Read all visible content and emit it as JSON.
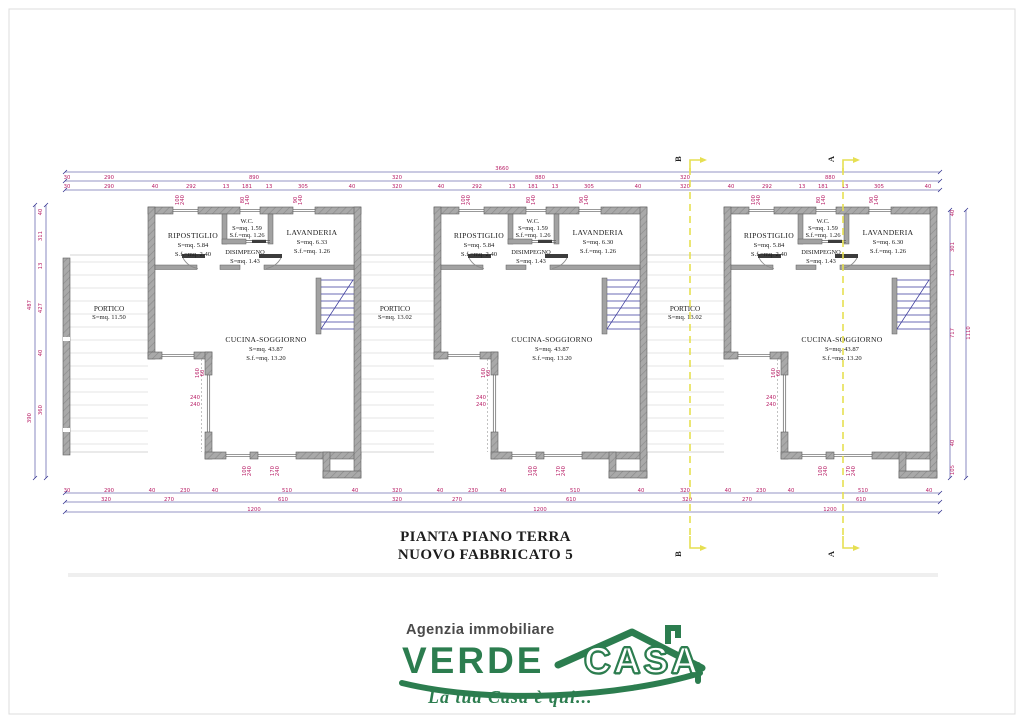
{
  "drawing": {
    "title_line1": "PIANTA PIANO TERRA",
    "title_line2": "NUOVO FABBRICATO 5"
  },
  "logo": {
    "tagline_top": "Agenzia immobiliare",
    "brand_word1": "VERDE",
    "brand_word2": "CASA",
    "tagline_bottom": "La tua Casa è qui...",
    "green": "#2c7d4f",
    "gray": "#4a4a4a"
  },
  "section_markers": {
    "b": "B",
    "a": "A"
  },
  "units": [
    {
      "portico_label": "PORTICO",
      "portico_area": "S=mq. 11.50",
      "ripostiglio_label": "RIPOSTIGLIO",
      "ripostiglio_s": "S=mq. 5.84",
      "ripostiglio_sf": "S.f.=mq. 2.40",
      "wc_label": "W.C.",
      "wc_s": "S=mq. 1.59",
      "wc_sf": "S.f.=mq. 1.26",
      "lavanderia_label": "LAVANDERIA",
      "lavanderia_s": "S=mq. 6.33",
      "lavanderia_sf": "S.f.=mq. 1.26",
      "disimpegno_label": "DISIMPEGNO",
      "disimpegno_s": "S=mq. 1.43",
      "cucina_label": "CUCINA-SOGGIORNO",
      "cucina_s": "S=mq. 43.87",
      "cucina_sf": "S.f.=mq. 13.20"
    },
    {
      "portico_label": "PORTICO",
      "portico_area": "S=mq. 13.02",
      "ripostiglio_label": "RIPOSTIGLIO",
      "ripostiglio_s": "S=mq. 5.84",
      "ripostiglio_sf": "S.f.=mq. 2.40",
      "wc_label": "W.C.",
      "wc_s": "S=mq. 1.59",
      "wc_sf": "S.f.=mq. 1.26",
      "lavanderia_label": "LAVANDERIA",
      "lavanderia_s": "S=mq. 6.30",
      "lavanderia_sf": "S.f.=mq. 1.26",
      "disimpegno_label": "DISIMPEGNO",
      "disimpegno_s": "S=mq. 1.43",
      "cucina_label": "CUCINA-SOGGIORNO",
      "cucina_s": "S=mq. 43.87",
      "cucina_sf": "S.f.=mq. 13.20"
    },
    {
      "portico_label": "PORTICO",
      "portico_area": "S=mq. 13.02",
      "ripostiglio_label": "RIPOSTIGLIO",
      "ripostiglio_s": "S=mq. 5.84",
      "ripostiglio_sf": "S.f.=mq. 2.40",
      "wc_label": "W.C.",
      "wc_s": "S=mq. 1.59",
      "wc_sf": "S.f.=mq. 1.26",
      "lavanderia_label": "LAVANDERIA",
      "lavanderia_s": "S=mq. 6.30",
      "lavanderia_sf": "S.f.=mq. 1.26",
      "disimpegno_label": "DISIMPEGNO",
      "disimpegno_s": "S=mq. 1.43",
      "cucina_label": "CUCINA-SOGGIORNO",
      "cucina_s": "S=mq. 43.87",
      "cucina_sf": "S.f.=mq. 13.20"
    }
  ],
  "opening_labels": [
    {
      "a": "100",
      "b": "240",
      "x": 31,
      "y": -7,
      "rot": true
    },
    {
      "a": "80",
      "b": "140",
      "x": 96,
      "y": -7,
      "rot": true
    },
    {
      "a": "90",
      "b": "140",
      "x": 149,
      "y": -7,
      "rot": true
    },
    {
      "a": "160",
      "b": "60",
      "x": 51,
      "y": 166,
      "rot": true
    },
    {
      "a": "240",
      "b": "240",
      "x": 47,
      "y": 192,
      "rot": false
    },
    {
      "a": "100",
      "b": "240",
      "x": 98,
      "y": 264,
      "rot": true
    },
    {
      "a": "170",
      "b": "240",
      "x": 126,
      "y": 264,
      "rot": true
    }
  ],
  "dim_labels": {
    "top": [
      [
        "3660",
        502,
        170
      ],
      [
        "30",
        67,
        179
      ],
      [
        "290",
        109,
        179
      ],
      [
        "890",
        254,
        179
      ],
      [
        "320",
        397,
        179
      ],
      [
        "880",
        540,
        179
      ],
      [
        "320",
        685,
        179
      ],
      [
        "880",
        830,
        179
      ],
      [
        "30",
        67,
        188
      ],
      [
        "290",
        109,
        188
      ],
      [
        "40",
        155,
        188
      ],
      [
        "292",
        191,
        188
      ],
      [
        "13",
        226,
        188
      ],
      [
        "181",
        247,
        188
      ],
      [
        "13",
        269,
        188
      ],
      [
        "305",
        303,
        188
      ],
      [
        "40",
        352,
        188
      ],
      [
        "320",
        397,
        188
      ],
      [
        "40",
        441,
        188
      ],
      [
        "292",
        477,
        188
      ],
      [
        "13",
        512,
        188
      ],
      [
        "181",
        533,
        188
      ],
      [
        "13",
        555,
        188
      ],
      [
        "305",
        589,
        188
      ],
      [
        "40",
        638,
        188
      ],
      [
        "320",
        685,
        188
      ],
      [
        "40",
        731,
        188
      ],
      [
        "292",
        767,
        188
      ],
      [
        "13",
        802,
        188
      ],
      [
        "181",
        823,
        188
      ],
      [
        "13",
        845,
        188
      ],
      [
        "305",
        879,
        188
      ],
      [
        "40",
        928,
        188
      ]
    ],
    "bottom": [
      [
        "30",
        67,
        492
      ],
      [
        "290",
        109,
        492
      ],
      [
        "40",
        152,
        492
      ],
      [
        "230",
        185,
        492
      ],
      [
        "40",
        215,
        492
      ],
      [
        "510",
        287,
        492
      ],
      [
        "40",
        355,
        492
      ],
      [
        "320",
        397,
        492
      ],
      [
        "40",
        440,
        492
      ],
      [
        "230",
        473,
        492
      ],
      [
        "40",
        503,
        492
      ],
      [
        "510",
        575,
        492
      ],
      [
        "40",
        641,
        492
      ],
      [
        "320",
        685,
        492
      ],
      [
        "40",
        728,
        492
      ],
      [
        "230",
        761,
        492
      ],
      [
        "40",
        791,
        492
      ],
      [
        "510",
        863,
        492
      ],
      [
        "40",
        929,
        492
      ],
      [
        "320",
        106,
        501
      ],
      [
        "270",
        169,
        501
      ],
      [
        "610",
        283,
        501
      ],
      [
        "320",
        397,
        501
      ],
      [
        "270",
        457,
        501
      ],
      [
        "610",
        571,
        501
      ],
      [
        "320",
        687,
        501
      ],
      [
        "270",
        747,
        501
      ],
      [
        "610",
        861,
        501
      ],
      [
        "1200",
        254,
        511
      ],
      [
        "1200",
        540,
        511
      ],
      [
        "1200",
        830,
        511
      ]
    ],
    "left": [
      [
        "40",
        42,
        212
      ],
      [
        "311",
        42,
        236
      ],
      [
        "13",
        42,
        266
      ],
      [
        "427",
        42,
        308
      ],
      [
        "40",
        42,
        353
      ],
      [
        "360",
        42,
        410
      ],
      [
        "487",
        31,
        305
      ],
      [
        "390",
        31,
        418
      ]
    ],
    "right": [
      [
        "40",
        954,
        213
      ],
      [
        "301",
        954,
        247
      ],
      [
        "13",
        954,
        273
      ],
      [
        "717",
        954,
        333
      ],
      [
        "40",
        954,
        443
      ],
      [
        "105",
        954,
        470
      ],
      [
        "1110",
        970,
        333
      ]
    ]
  },
  "colors": {
    "wall_gray": "#a9a9a9",
    "wall_hatch": "#8a8a8a",
    "wall_edge": "#5f5f5f",
    "dim_line": "#2a2a8c",
    "dim_text": "#b81e66",
    "stair_line": "#3a3a9c",
    "section_yellow": "#e6df52",
    "paving": "#dcdcdc",
    "logo_green": "#2c7d4f",
    "text_dark": "#1d1d1d"
  }
}
